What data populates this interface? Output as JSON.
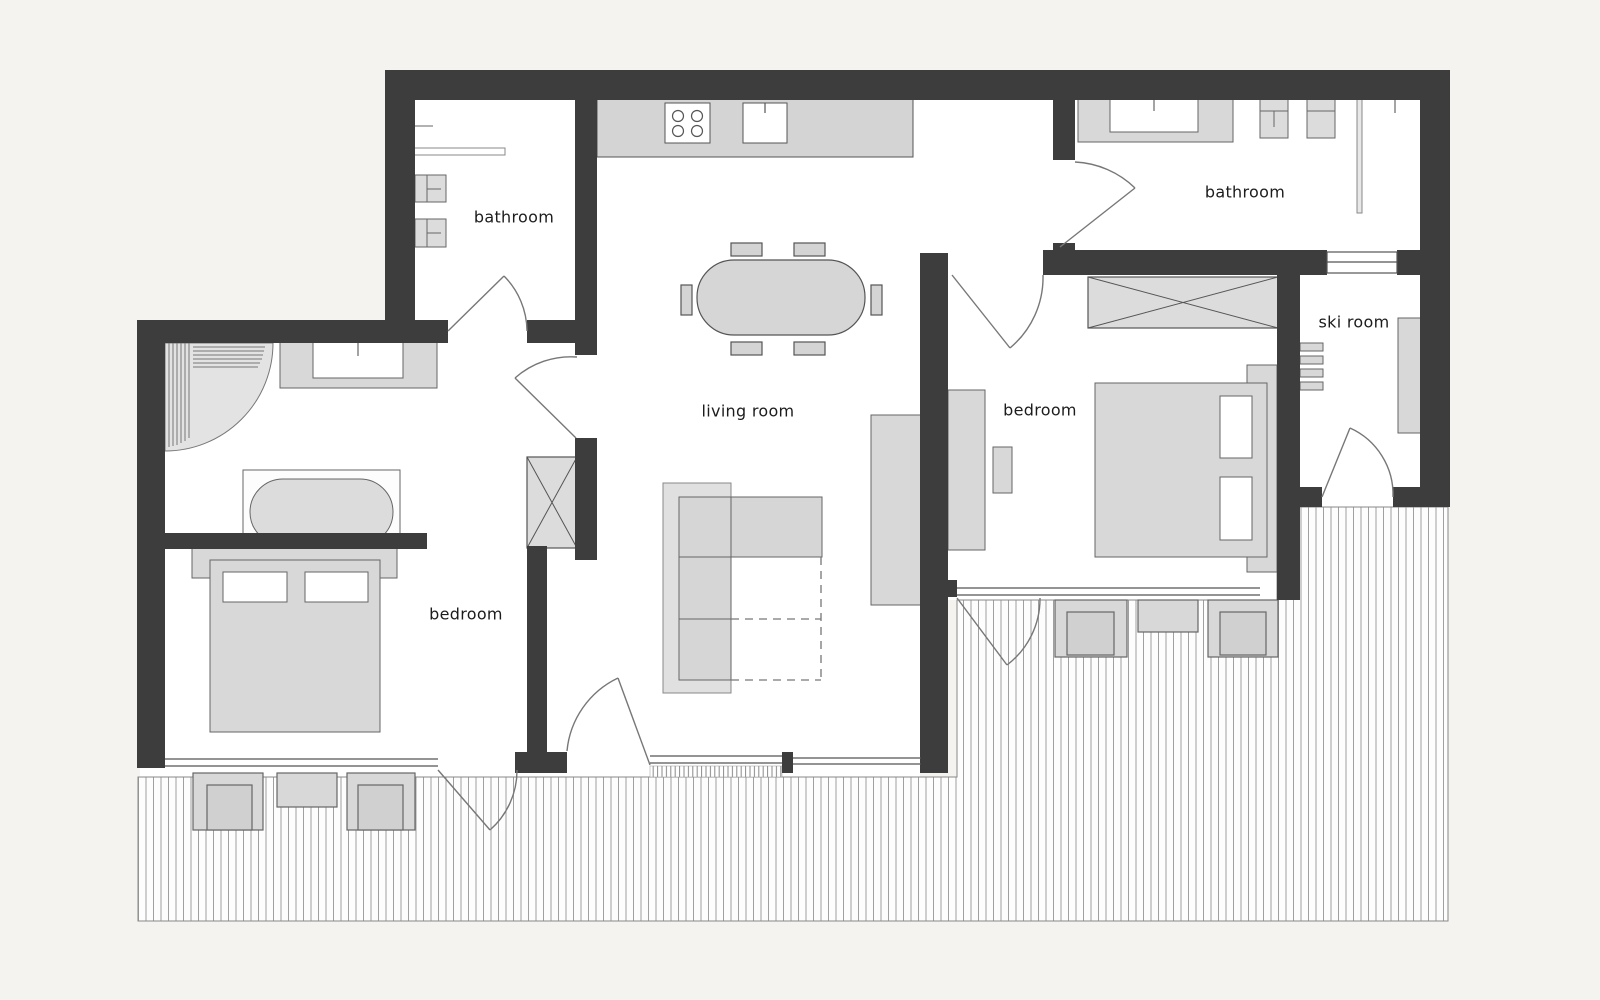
{
  "plan": {
    "type": "apartment-floor-plan",
    "rooms": [
      {
        "id": "bathroom-left",
        "label": "bathroom"
      },
      {
        "id": "living-room",
        "label": "living room"
      },
      {
        "id": "bedroom-left",
        "label": "bedroom"
      },
      {
        "id": "bedroom-right",
        "label": "bedroom"
      },
      {
        "id": "ski-room",
        "label": "ski room"
      },
      {
        "id": "bathroom-right",
        "label": "bathroom"
      }
    ],
    "colors": {
      "background": "#f4f3ef",
      "wall": "#3d3d3d",
      "floor": "#ffffff",
      "furniture_fill": "#d8d8d8",
      "furniture_line": "#606060",
      "deck_hatch": "#a0a0a0"
    }
  }
}
